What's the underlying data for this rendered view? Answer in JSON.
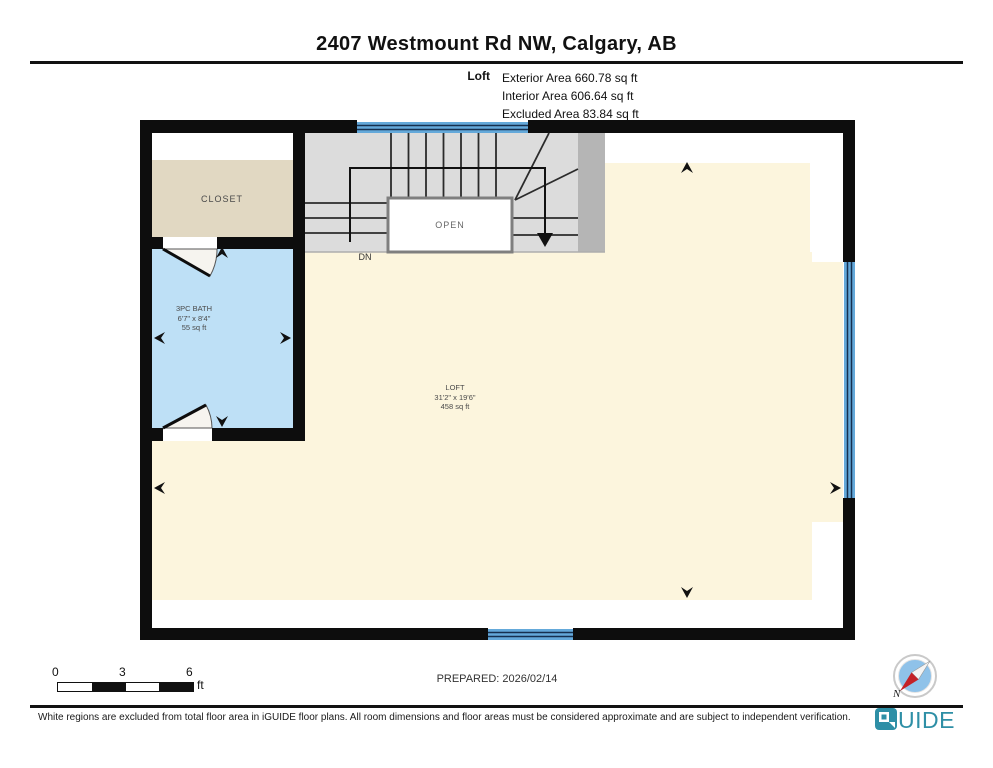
{
  "header": {
    "title": "2407 Westmount Rd NW, Calgary, AB",
    "floor_label": "Loft",
    "area_lines": {
      "exterior": "Exterior Area 660.78 sq ft",
      "interior": "Interior Area 606.64 sq ft",
      "excluded": "Excluded Area 83.84 sq ft"
    }
  },
  "plan": {
    "closet_label": "CLOSET",
    "open_label": "OPEN",
    "down_label": "DN",
    "bath": {
      "name": "3PC BATH",
      "dims": "6'7\" x 8'4\"",
      "area": "55 sq ft"
    },
    "loft": {
      "name": "LOFT",
      "dims": "31'2\" x 19'6\"",
      "area": "458 sq ft"
    }
  },
  "scale_bar": {
    "ticks": [
      "0",
      "3",
      "6"
    ],
    "unit": "ft"
  },
  "prepared": "PREPARED: 2026/02/14",
  "compass": {
    "north_label": "N"
  },
  "footer": {
    "disclaimer": "White regions are excluded from total floor area in iGUIDE floor plans. All room dimensions and floor areas must be considered approximate and are subject to independent verification.",
    "brand": "iGUIDE"
  },
  "colors": {
    "loft_fill": "#FCF5DD",
    "closet_fill": "#E1D8C2",
    "bath_fill": "#BEE0F6",
    "stair_fill": "#DCDCDC",
    "stair_edge": "#B5B5B5",
    "open_fill": "#FFFFFF",
    "window_fill": "#64A9DA",
    "window_line": "#16304F",
    "wall": "#0D0D0D",
    "door_sweep": "#F6F4EF",
    "brand_teal": "#2E8FA6",
    "compass_red": "#C42127",
    "compass_blue": "#8FC2E9"
  }
}
